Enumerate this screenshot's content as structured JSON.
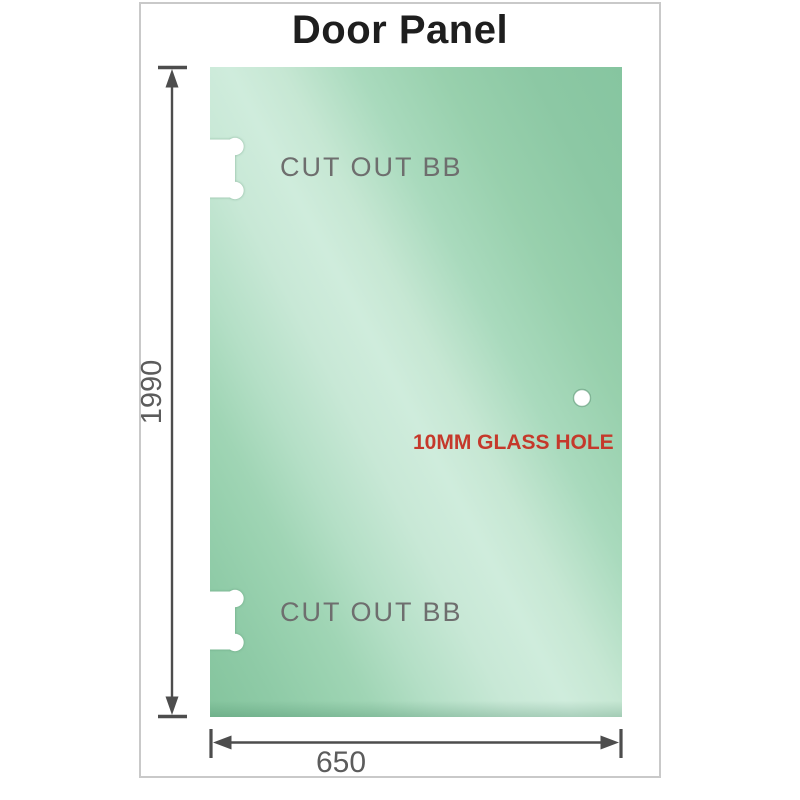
{
  "title": "Door Panel",
  "diagram": {
    "height_label": "1990",
    "width_label": "650",
    "cutout_top_label": "CUT OUT BB",
    "cutout_bottom_label": "CUT OUT BB",
    "hole_label": "10MM GLASS HOLE"
  },
  "colors": {
    "glass_dark": "#86c59f",
    "glass_light": "#cfecdc",
    "dimension_lines": "#4d4d4d",
    "cutout_label": "#6e6e6e",
    "hole_label": "#c5392b",
    "title_text": "#1e1e1e",
    "card_border": "#c9c9c9"
  }
}
